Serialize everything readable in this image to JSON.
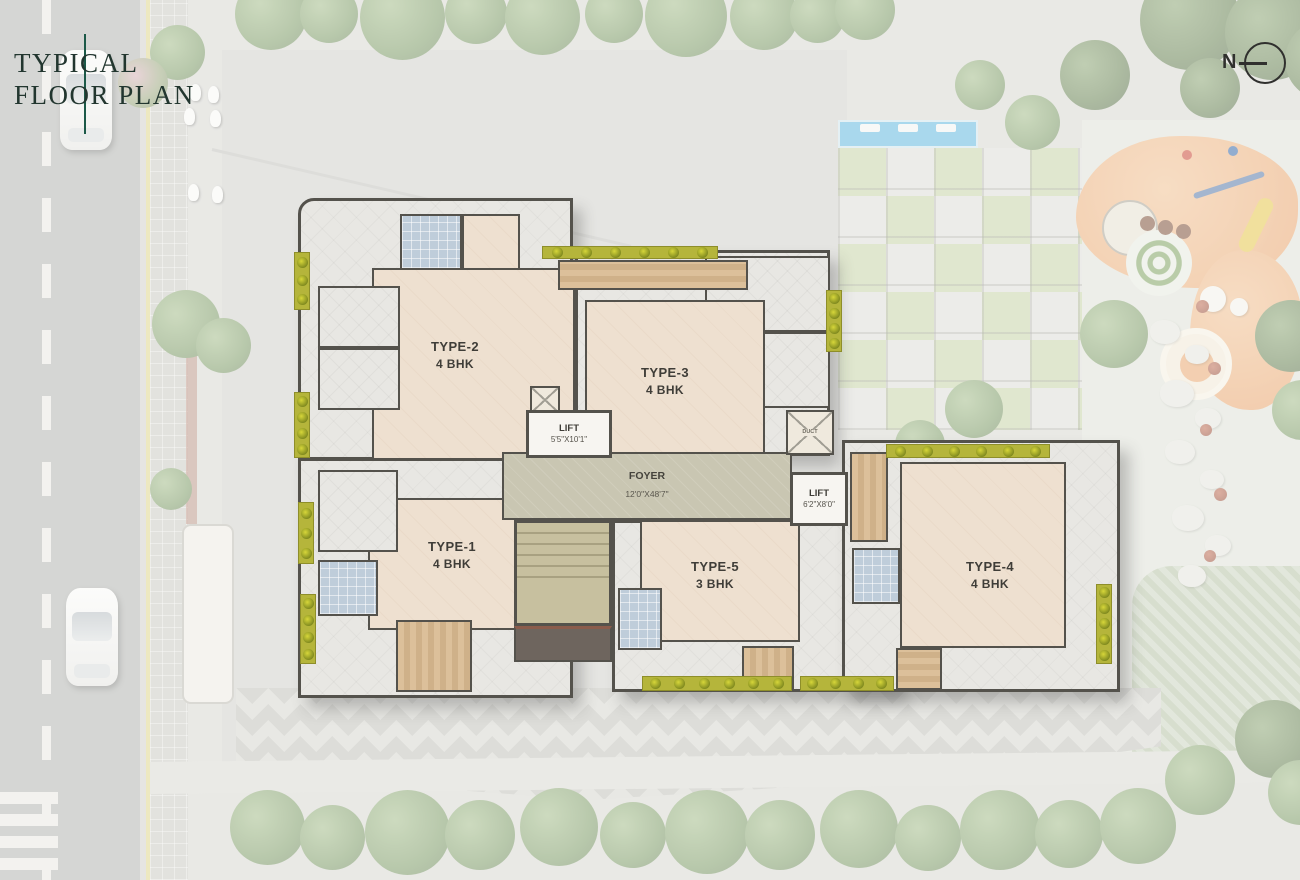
{
  "header": {
    "title_line1": "TYPICAL",
    "title_line2": "FLOOR PLAN"
  },
  "compass": {
    "label": "N"
  },
  "plan": {
    "units": [
      {
        "name": "TYPE-2",
        "bhk": "4 BHK"
      },
      {
        "name": "TYPE-3",
        "bhk": "4 BHK"
      },
      {
        "name": "TYPE-1",
        "bhk": "4 BHK"
      },
      {
        "name": "TYPE-5",
        "bhk": "3 BHK"
      },
      {
        "name": "TYPE-4",
        "bhk": "4 BHK"
      }
    ],
    "lift_small": {
      "label": "LIFT",
      "dim": "5'5\"X10'1\""
    },
    "lift_large": {
      "label": "LIFT",
      "dim": "6'2\"X8'0\""
    },
    "foyer": {
      "label": "FOYER",
      "dim": "12'0\"X48'7\""
    },
    "duct": {
      "label": "DUCT"
    }
  },
  "colors": {
    "accent_line": "#1c5948",
    "wall": "#54524c",
    "living": "#eee0d0",
    "planter": "#b5b53b",
    "pool": "#5fb9e2",
    "playground": "#eba066"
  }
}
